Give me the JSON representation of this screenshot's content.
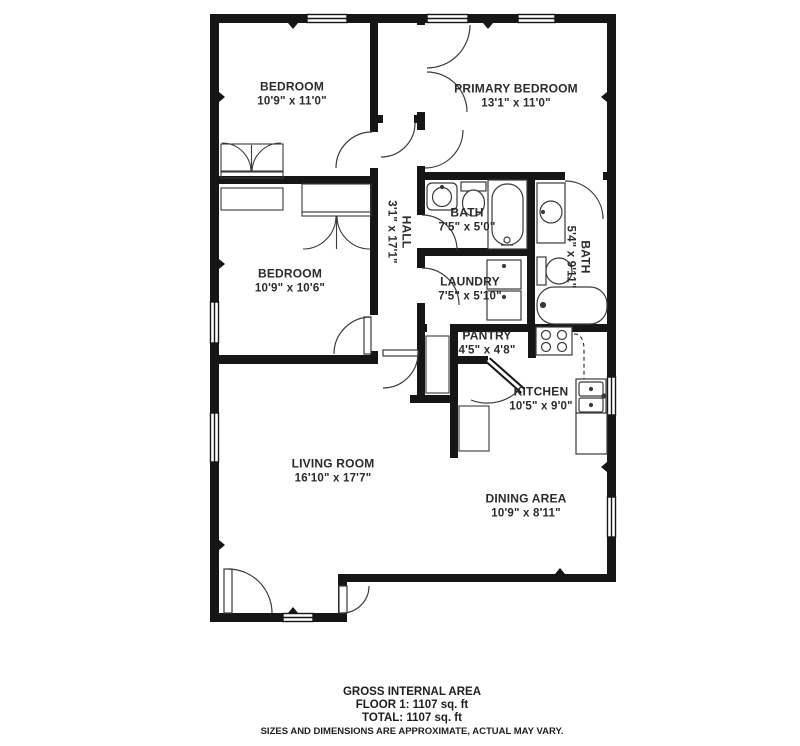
{
  "meta": {
    "background_color": "#ffffff",
    "wall_color": "#161616",
    "text_color": "#2b2b2b"
  },
  "rooms": [
    {
      "id": "bedroom-1",
      "name": "BEDROOM",
      "dims": "10'9\" x 11'0\""
    },
    {
      "id": "primary-bedroom",
      "name": "PRIMARY BEDROOM",
      "dims": "13'1\" x 11'0\""
    },
    {
      "id": "hall",
      "name": "HALL",
      "dims": "3'1\" x 17'1\""
    },
    {
      "id": "bath-1",
      "name": "BATH",
      "dims": "7'5\" x 5'0\""
    },
    {
      "id": "bath-2",
      "name": "BATH",
      "dims": "5'4\" x 9'11\""
    },
    {
      "id": "laundry",
      "name": "LAUNDRY",
      "dims": "7'5\" x 5'10\""
    },
    {
      "id": "bedroom-2",
      "name": "BEDROOM",
      "dims": "10'9\" x 10'6\""
    },
    {
      "id": "pantry",
      "name": "PANTRY",
      "dims": "4'5\" x 4'8\""
    },
    {
      "id": "kitchen",
      "name": "KITCHEN",
      "dims": "10'5\" x 9'0\""
    },
    {
      "id": "living-room",
      "name": "LIVING ROOM",
      "dims": "16'10\" x 17'7\""
    },
    {
      "id": "dining-area",
      "name": "DINING AREA",
      "dims": "10'9\" x 8'11\""
    }
  ],
  "footer": {
    "line1": "GROSS INTERNAL AREA",
    "line2": "FLOOR 1: 1107 sq. ft",
    "line3": "TOTAL: 1107 sq. ft",
    "disclaimer": "SIZES AND DIMENSIONS ARE APPROXIMATE, ACTUAL MAY VARY."
  }
}
